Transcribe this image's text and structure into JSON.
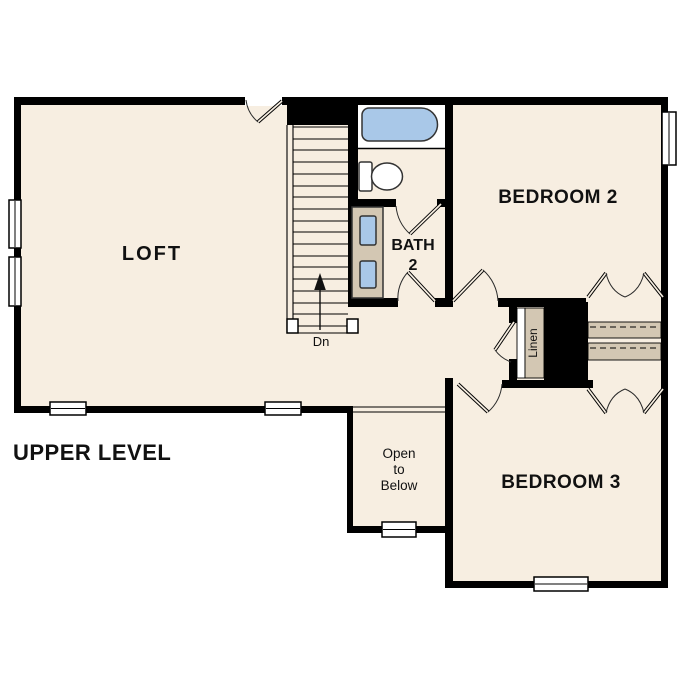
{
  "plan": {
    "title": "UPPER LEVEL",
    "rooms": {
      "loft": "LOFT",
      "bedroom2": "BEDROOM 2",
      "bedroom3": "BEDROOM 3",
      "bath_line1": "BATH",
      "bath_line2": "2",
      "linen": "Linen",
      "stair_direction": "Dn",
      "open_to_below": [
        "Open",
        "to",
        "Below"
      ]
    },
    "colors": {
      "background": "#ffffff",
      "floor": "#f7eee1",
      "wall": "#000000",
      "fixture_blue": "#a9c8e8",
      "casework_tan": "#d3c7b3",
      "window_white": "#ffffff"
    },
    "icons": [
      "bathtub-icon",
      "toilet-icon",
      "vanity-sink-icon",
      "stairs",
      "stair-direction-arrow",
      "door-swing",
      "bifold-door",
      "window",
      "closet-shelf"
    ]
  }
}
